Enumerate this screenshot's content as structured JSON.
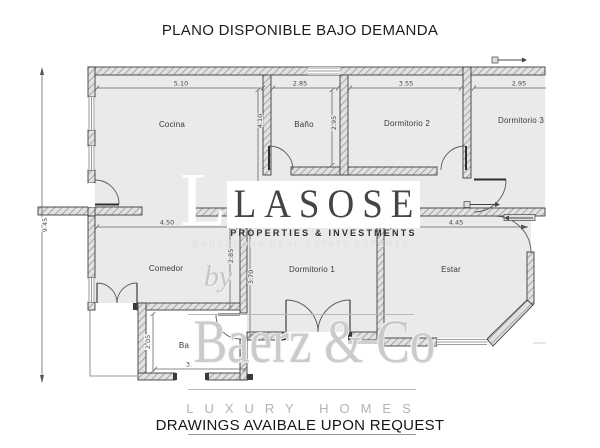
{
  "title": "PLANO DISPONIBLE BAJO DEMANDA",
  "footer_note": "DRAWINGS AVAIBALE UPON REQUEST",
  "watermark": {
    "initial": "L",
    "brand": "LASOSE",
    "brand_tagline": "PROPERTIES & INVESTMENTS",
    "brand_subtitle": "BARCELONA REAL ESTATE EXPERTS",
    "by_label": "by",
    "agency": "Baerz & Co",
    "agency_tagline": "LUXURY HOMES"
  },
  "floorplan": {
    "rooms": [
      {
        "name": "Cocina"
      },
      {
        "name": "Baño"
      },
      {
        "name": "Dormitorio 2"
      },
      {
        "name": "Dormitorio 3"
      },
      {
        "name": "Comedor"
      },
      {
        "name": "Dormitorio 1"
      },
      {
        "name": "Estar"
      },
      {
        "name": "Ba"
      }
    ],
    "dims": {
      "cocina_w": "5.10",
      "bano_w": "2.85",
      "dorm2_w": "3.55",
      "dorm3_w": "2.95",
      "cocina_h": "4.10",
      "bano_h": "2.95",
      "comedor_w": "4.50",
      "estar_w": "4.45",
      "comedor_h": "2.85",
      "dorm1_h": "3.70",
      "total_h": "9.45",
      "ba_h": "2.05",
      "ba_w": "3."
    },
    "colors": {
      "room_fill": "#eaeaea",
      "wall_line": "#3f3f3f",
      "watermark_gray": "#cbcbcb"
    }
  }
}
